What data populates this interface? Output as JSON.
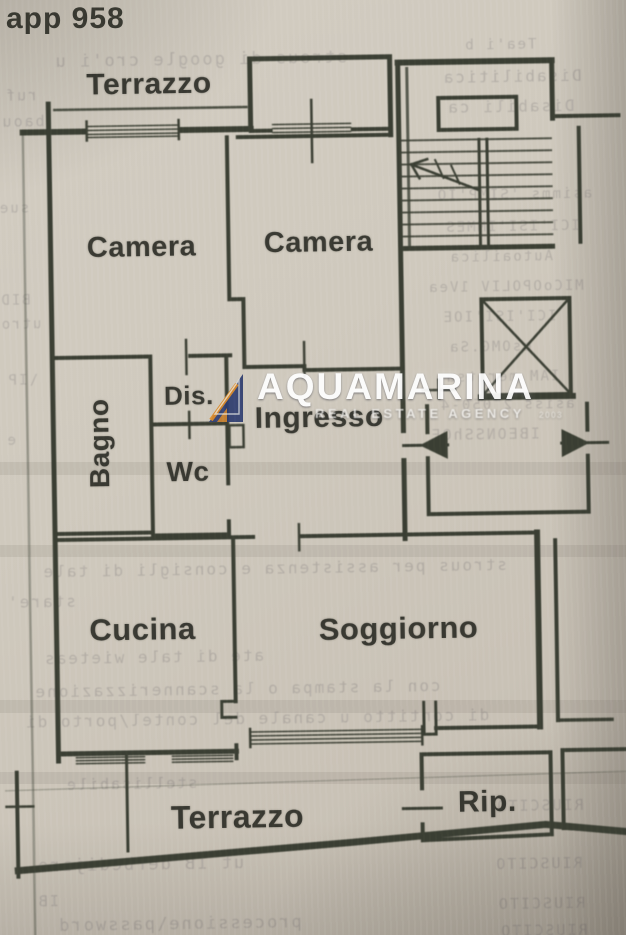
{
  "page": {
    "apartment_number": "app 958"
  },
  "plan": {
    "wall_color": "#3a3e33",
    "paper_color": "#cfc9bd",
    "labels": {
      "terrazzo_top": "Terrazzo",
      "camera_left": "Camera",
      "camera_right": "Camera",
      "bagno": "Bagno",
      "dis": "Dis.",
      "wc": "Wc",
      "ingresso": "Ingresso",
      "cucina": "Cucina",
      "soggiorno": "Soggiorno",
      "terrazzo_bottom": "Terrazzo",
      "rip": "Rip."
    }
  },
  "watermark": {
    "brand": "AQUAMARINA",
    "tagline": "REAL ESTATE AGENCY",
    "year_mark": "2003",
    "logo_navy": "#2e3c6e",
    "logo_orange": "#d98a2c"
  },
  "bleed_text": {
    "lines": [
      "strous di google cro'i u",
      "ruf",
      "baou",
      "sue",
      "BID",
      "utro",
      "\\IP",
      "e",
      "Tea'i b",
      "Disabilitica",
      "Disabili ca",
      "asimms 'SIMP'IO",
      "ICI'ISI'IMMES",
      "Autoailica",
      "MICoOPOLIV 1Vea",
      "ICI'ISI'IOE",
      "esOMG.Sa",
      "IAM meritsa",
      "asiss 2 050-4",
      "IBEONSShOE",
      "strous per assistenza e consigli di tale",
      "stare'",
      "ate di tale wieteas",
      "con la stampa  o  la scannerizzazione",
      "di contitto u   canale del   contel/porto di",
      "stellisabile",
      "ut IB derbedijare",
      "IB",
      "processione\\password",
      "RIUSCITO",
      "RIUSCITO",
      "RIUSCITO",
      "RIUSCITO"
    ]
  }
}
